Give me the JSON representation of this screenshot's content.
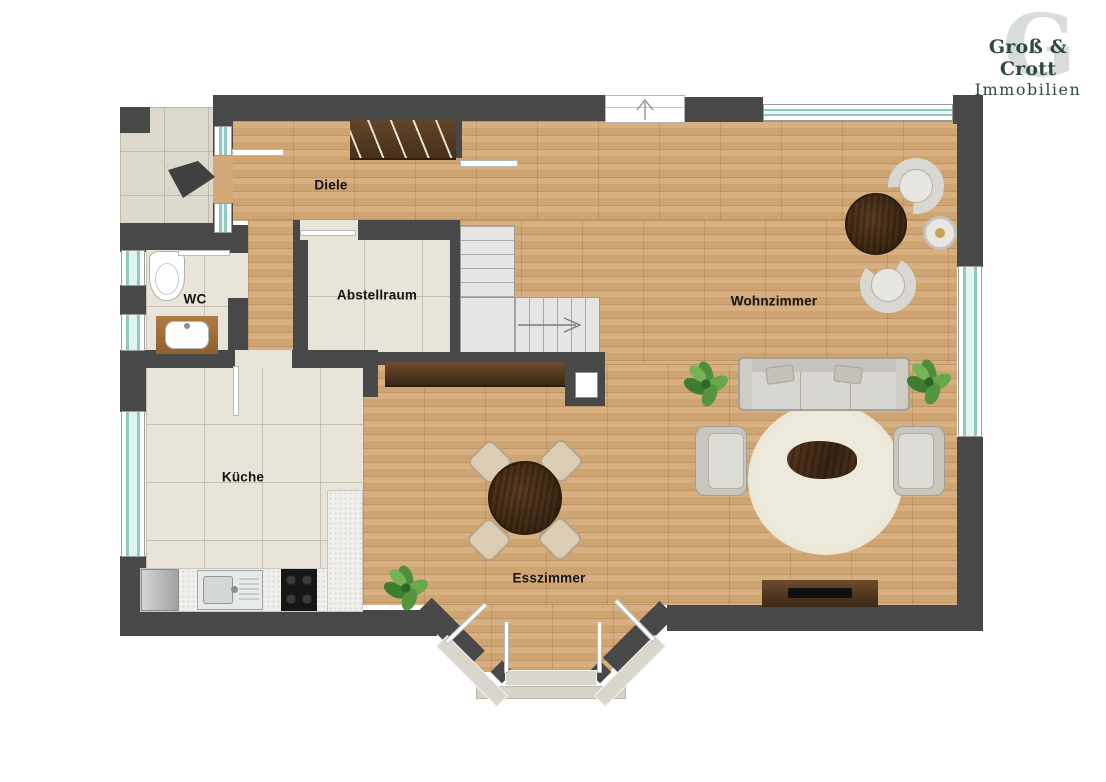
{
  "brand": {
    "name": "Groß & Crott",
    "subtitle": "Immobilien",
    "watermark_letter": "G",
    "brand_color": "#2e4a3f"
  },
  "rooms": [
    {
      "id": "diele",
      "label": "Diele"
    },
    {
      "id": "wc",
      "label": "WC"
    },
    {
      "id": "abstellraum",
      "label": "Abstellraum"
    },
    {
      "id": "kueche",
      "label": "Küche"
    },
    {
      "id": "esszimmer",
      "label": "Esszimmer"
    },
    {
      "id": "wohnzimmer",
      "label": "Wohnzimmer"
    }
  ],
  "colors": {
    "wall": "#484848",
    "wood_floor": "#d1a876",
    "tile_floor": "#e9e4d9",
    "window_glass": "#8fc9c4",
    "stairs": "#e7e5e4",
    "rug": "#ebe7d9",
    "dark_wood_furniture": "#4a3220",
    "upholstery": "#d7d5cf",
    "plant_green": "#4f8f3b",
    "counter": "#f0efeb"
  },
  "icons": [
    "entry-direction-arrow-icon",
    "entrance-door-arrow-icon",
    "stairs-direction-arrow-icon",
    "wardrobe-icon",
    "staircase-icon",
    "sideboard-icon",
    "chimney-icon",
    "toilet-icon",
    "washbasin-vanity-icon",
    "fridge-icon",
    "kitchen-sink-icon",
    "cooktop-icon",
    "dining-table-icon",
    "dining-chair-icon",
    "plant-icon",
    "sofa-icon",
    "coffee-table-icon",
    "rug-icon",
    "armchair-icon",
    "side-table-icon",
    "round-table-icon",
    "tv-lowboard-icon",
    "window-icon",
    "door-leaf-icon"
  ]
}
